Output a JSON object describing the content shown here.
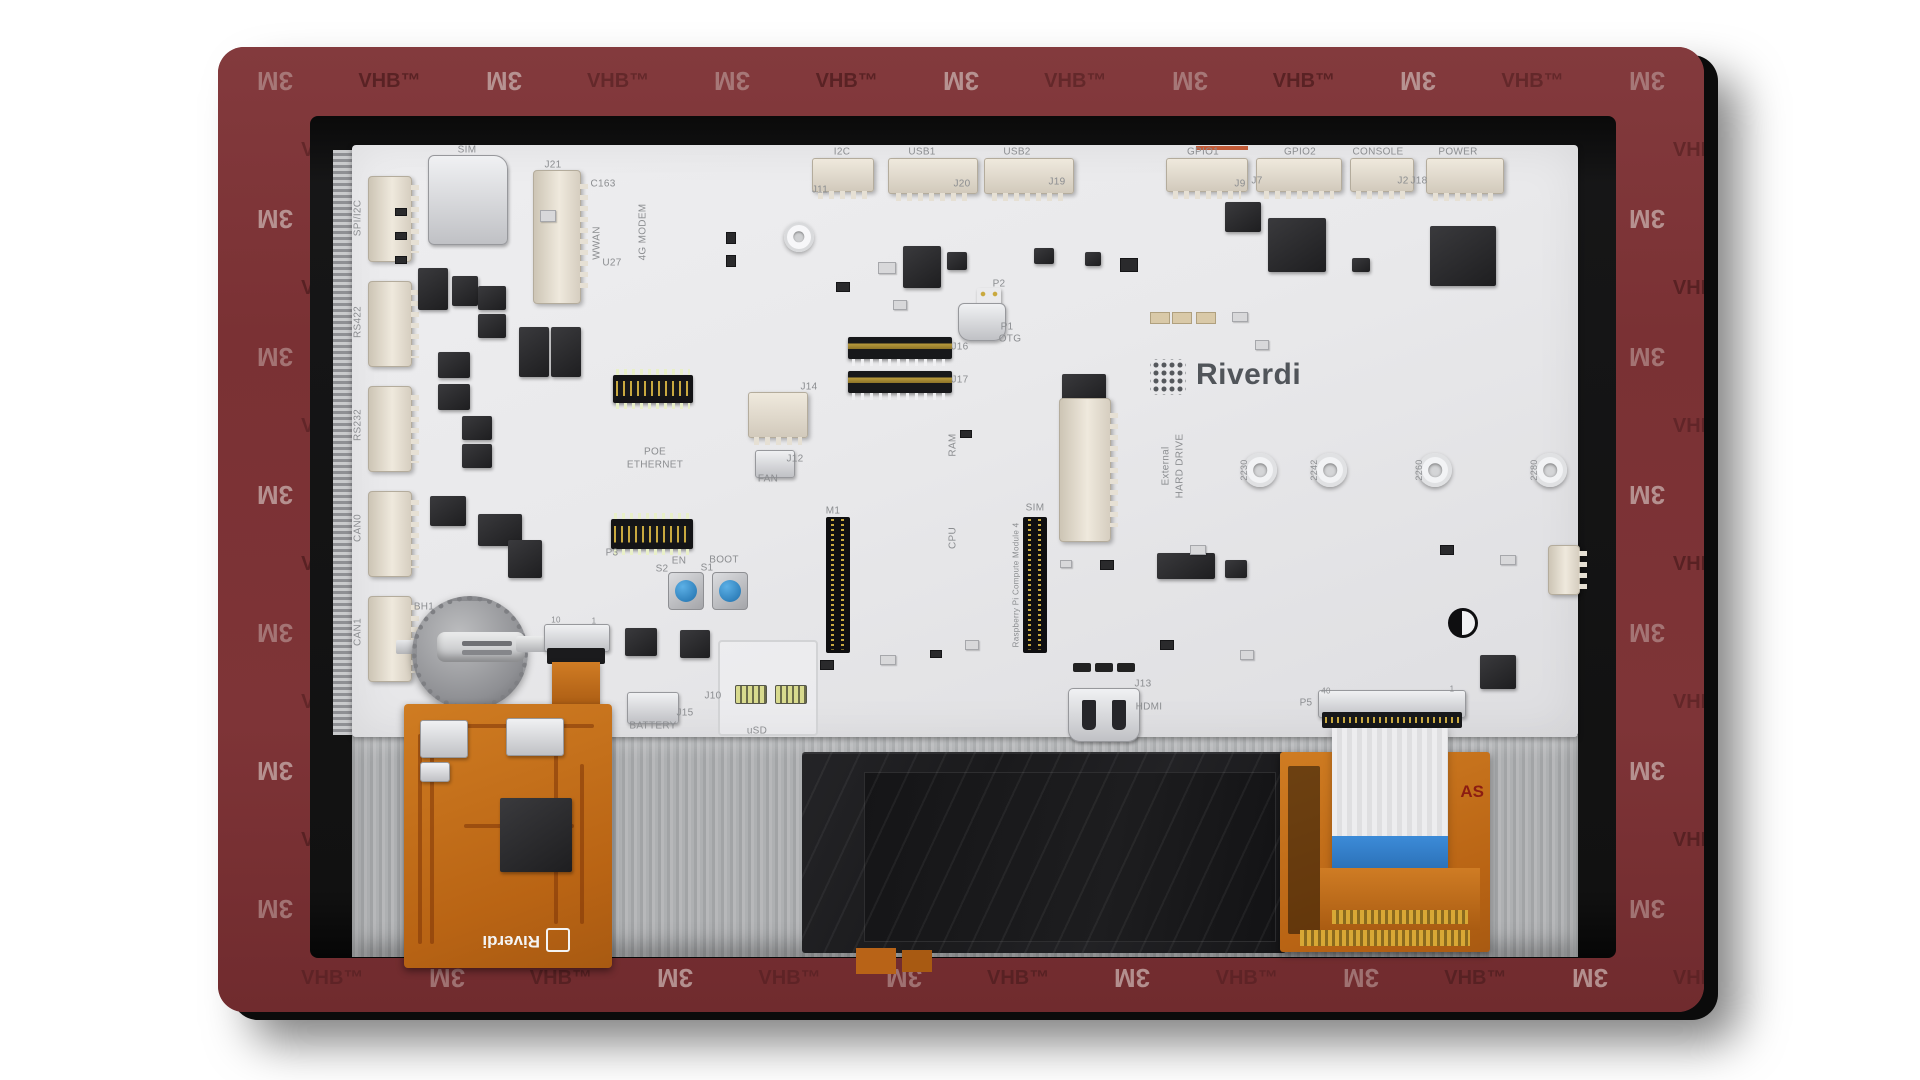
{
  "scene": {
    "description": "Product render of a Riverdi embedded single-board computer display module, backside view, framed by 3M VHB adhesive tape border",
    "brand": "Riverdi"
  },
  "tape": {
    "brand_token": "3M",
    "product_token": "VHB™",
    "rows": 14,
    "cols": 13,
    "bg_color": "#7c3336",
    "light_token_color": "#c5aaa8",
    "dark_token_color": "#552022"
  },
  "logo": {
    "text": "Riverdi"
  },
  "flex_board": {
    "logo_text": "Riverdi"
  },
  "right_flex_marking": "AS",
  "accent_colors": {
    "gpio1_marker": "#c25b37",
    "button_blue": "#3b9bd8",
    "ribbon_blue": "#2f7fd6",
    "flex_orange": "#c9731d"
  },
  "silkscreen": [
    {
      "t": "SPI/I2C",
      "x": 358,
      "y": 218,
      "r": -90
    },
    {
      "t": "RS422",
      "x": 358,
      "y": 322,
      "r": -90
    },
    {
      "t": "RS232",
      "x": 358,
      "y": 425,
      "r": -90
    },
    {
      "t": "CAN0",
      "x": 358,
      "y": 528,
      "r": -90
    },
    {
      "t": "CAN1",
      "x": 358,
      "y": 632,
      "r": -90
    },
    {
      "t": "SIM",
      "x": 467,
      "y": 150
    },
    {
      "t": "J21",
      "x": 553,
      "y": 165
    },
    {
      "t": "C163",
      "x": 603,
      "y": 184
    },
    {
      "t": "WWAN",
      "x": 597,
      "y": 243,
      "r": -90
    },
    {
      "t": "4G MODEM",
      "x": 643,
      "y": 232,
      "r": -90
    },
    {
      "t": "U27",
      "x": 612,
      "y": 263
    },
    {
      "t": "I2C",
      "x": 842,
      "y": 152
    },
    {
      "t": "J11",
      "x": 820,
      "y": 190
    },
    {
      "t": "USB1",
      "x": 922,
      "y": 152
    },
    {
      "t": "J20",
      "x": 962,
      "y": 184
    },
    {
      "t": "USB2",
      "x": 1017,
      "y": 152
    },
    {
      "t": "J19",
      "x": 1057,
      "y": 182
    },
    {
      "t": "GPIO1",
      "x": 1203,
      "y": 152
    },
    {
      "t": "J9",
      "x": 1240,
      "y": 184
    },
    {
      "t": "GPIO2",
      "x": 1300,
      "y": 152
    },
    {
      "t": "J7",
      "x": 1257,
      "y": 181
    },
    {
      "t": "CONSOLE",
      "x": 1378,
      "y": 152
    },
    {
      "t": "J2",
      "x": 1403,
      "y": 181
    },
    {
      "t": "J18",
      "x": 1419,
      "y": 181
    },
    {
      "t": "POWER",
      "x": 1458,
      "y": 152
    },
    {
      "t": "P2",
      "x": 999,
      "y": 284
    },
    {
      "t": "P1",
      "x": 1007,
      "y": 327
    },
    {
      "t": "OTG",
      "x": 1010,
      "y": 339
    },
    {
      "t": "J16",
      "x": 960,
      "y": 347
    },
    {
      "t": "J17",
      "x": 960,
      "y": 380
    },
    {
      "t": "J14",
      "x": 809,
      "y": 387
    },
    {
      "t": "J12",
      "x": 795,
      "y": 459
    },
    {
      "t": "FAN",
      "x": 768,
      "y": 479
    },
    {
      "t": "POE",
      "x": 655,
      "y": 452
    },
    {
      "t": "ETHERNET",
      "x": 655,
      "y": 465
    },
    {
      "t": "P3",
      "x": 612,
      "y": 553
    },
    {
      "t": "M1",
      "x": 833,
      "y": 511
    },
    {
      "t": "RAM",
      "x": 953,
      "y": 445,
      "r": -90
    },
    {
      "t": "CPU",
      "x": 953,
      "y": 538,
      "r": -90
    },
    {
      "t": "SIM",
      "x": 1035,
      "y": 508
    },
    {
      "t": "Raspberry Pi Compute Module 4",
      "x": 1017,
      "y": 585,
      "r": -90,
      "s": 8
    },
    {
      "t": "External",
      "x": 1166,
      "y": 466,
      "r": -90
    },
    {
      "t": "HARD DRIVE",
      "x": 1180,
      "y": 466,
      "r": -90
    },
    {
      "t": "2230",
      "x": 1245,
      "y": 470,
      "r": -90,
      "s": 9
    },
    {
      "t": "2242",
      "x": 1315,
      "y": 470,
      "r": -90,
      "s": 9
    },
    {
      "t": "2260",
      "x": 1420,
      "y": 470,
      "r": -90,
      "s": 9
    },
    {
      "t": "2280",
      "x": 1535,
      "y": 470,
      "r": -90,
      "s": 9
    },
    {
      "t": "EN",
      "x": 679,
      "y": 561
    },
    {
      "t": "S2",
      "x": 662,
      "y": 569
    },
    {
      "t": "BOOT",
      "x": 724,
      "y": 560
    },
    {
      "t": "S1",
      "x": 707,
      "y": 568
    },
    {
      "t": "BH1",
      "x": 424,
      "y": 607
    },
    {
      "t": "10",
      "x": 556,
      "y": 621,
      "s": 8
    },
    {
      "t": "1",
      "x": 594,
      "y": 622,
      "s": 8
    },
    {
      "t": "BATTERY",
      "x": 653,
      "y": 726
    },
    {
      "t": "J15",
      "x": 685,
      "y": 713
    },
    {
      "t": "J10",
      "x": 713,
      "y": 696
    },
    {
      "t": "uSD",
      "x": 757,
      "y": 731
    },
    {
      "t": "J13",
      "x": 1143,
      "y": 684
    },
    {
      "t": "HDMI",
      "x": 1149,
      "y": 707
    },
    {
      "t": "P5",
      "x": 1306,
      "y": 703
    },
    {
      "t": "40",
      "x": 1326,
      "y": 692,
      "s": 8
    },
    {
      "t": "1",
      "x": 1452,
      "y": 690,
      "s": 8
    }
  ]
}
